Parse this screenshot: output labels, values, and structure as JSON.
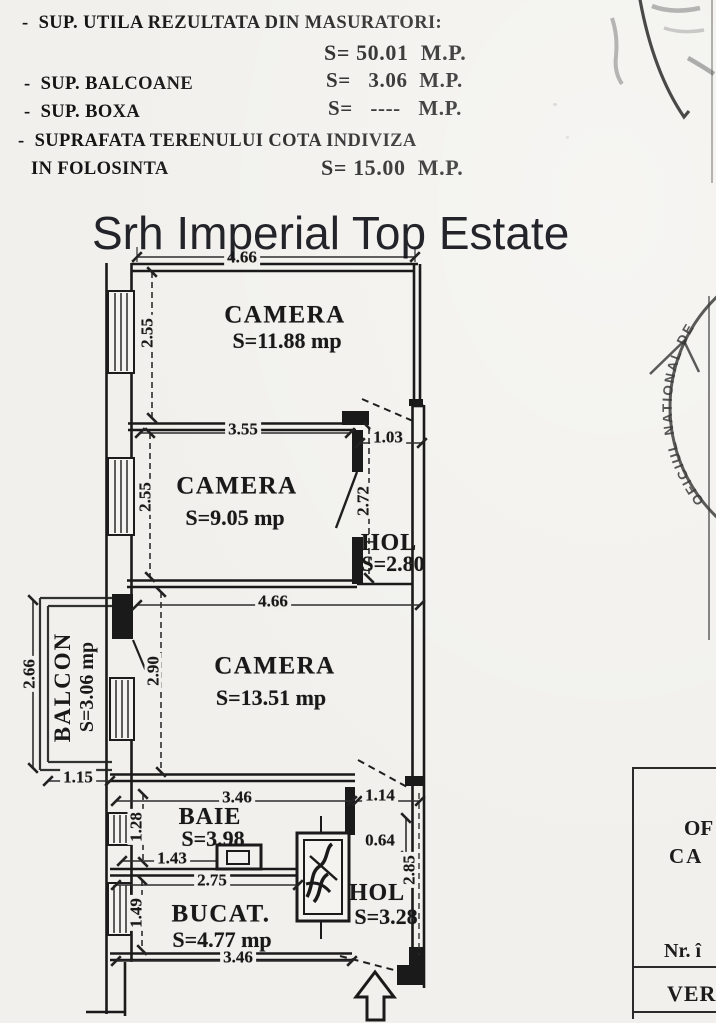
{
  "document": {
    "header": {
      "rows": [
        {
          "label": "-  SUP. UTILA REZULTATA DIN MASURATORI:",
          "value": "S= 50.01  M.P."
        },
        {
          "label": "-  SUP. BALCOANE",
          "value": "S=   3.06  M.P."
        },
        {
          "label": "-  SUP. BOXA",
          "value": "S=   ----   M.P."
        },
        {
          "label": "-  SUPRAFATA TERENULUI COTA INDIVIZA",
          "label_cont": "IN FOLOSINTA",
          "value": "S= 15.00  M.P."
        }
      ]
    },
    "watermark": "Srh Imperial Top Estate",
    "plan": {
      "rooms": {
        "camera1": {
          "name": "CAMERA",
          "area": "S=11.88 mp"
        },
        "camera2": {
          "name": "CAMERA",
          "area": "S=9.05 mp"
        },
        "hol1": {
          "name": "HOL",
          "area": "S=2.80"
        },
        "camera3": {
          "name": "CAMERA",
          "area": "S=13.51 mp"
        },
        "balcon": {
          "name": "BALCON",
          "area": "S=3.06 mp"
        },
        "baie": {
          "name": "BAIE",
          "area": "S=3.98"
        },
        "bucatarie": {
          "name": "BUCAT.",
          "area": "S=4.77 mp"
        },
        "hol2": {
          "name": "HOL",
          "area": "S=3.28"
        }
      },
      "dimensions": {
        "camera1_width": "4.66",
        "camera1_height": "2.55",
        "camera2_width": "3.55",
        "camera2_height": "2.55",
        "hall_top_width": "1.03",
        "hall_height": "2.72",
        "camera3_width": "4.66",
        "camera3_height": "2.90",
        "balcon_height": "2.66",
        "balcon_width": "1.15",
        "baie_width": "3.46",
        "hol2_top_width": "1.14",
        "baie_window_width": "1.28",
        "baie_door_width": "1.43",
        "bucatarie_width": "2.75",
        "hol2_niche_height": "0.64",
        "hol2_right_height": "2.85",
        "bucatarie_window_width": "1.49",
        "bucatarie_bottom_width": "3.46"
      }
    },
    "stamps": {
      "round_stamp_text": "OFICIUL NATIONAL DE",
      "info_box": {
        "line1": "OF",
        "line2": "CA",
        "line3": "Nr. î",
        "line4": "VER"
      }
    }
  }
}
